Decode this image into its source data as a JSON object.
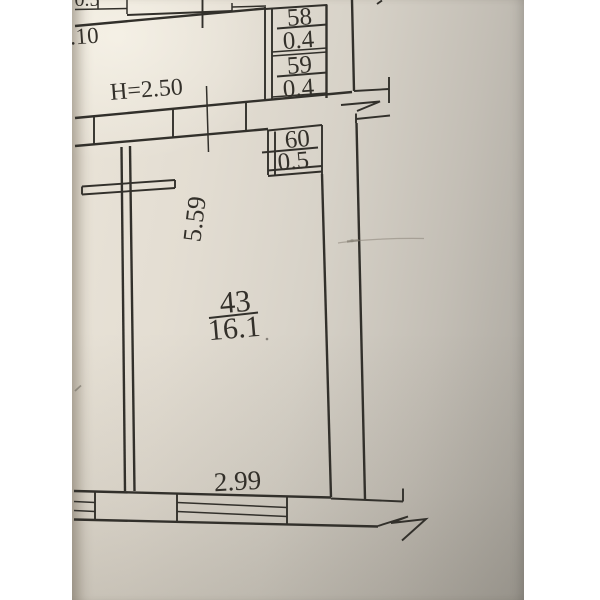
{
  "photo": {
    "description": "Photographed fragment of an apartment floor plan on paper",
    "paper_color": "#e3ddd2",
    "ink_color": "#32302b",
    "pencil_color": "#8a8478"
  },
  "plan": {
    "ceiling_height_label": "H=2.50",
    "main_room": {
      "number": "43",
      "area": "16.1"
    },
    "closets": [
      {
        "number": "58",
        "area": "0.4"
      },
      {
        "number": "59",
        "area": "0.4"
      },
      {
        "number": "60",
        "area": "0.5"
      }
    ],
    "dimensions": {
      "bottom_width": "2.99",
      "room_depth": "5.59",
      "left_edge_clipped": "5.59",
      "top_width_clipped": "0.10",
      "top_box_area_clipped": "0.5"
    }
  }
}
